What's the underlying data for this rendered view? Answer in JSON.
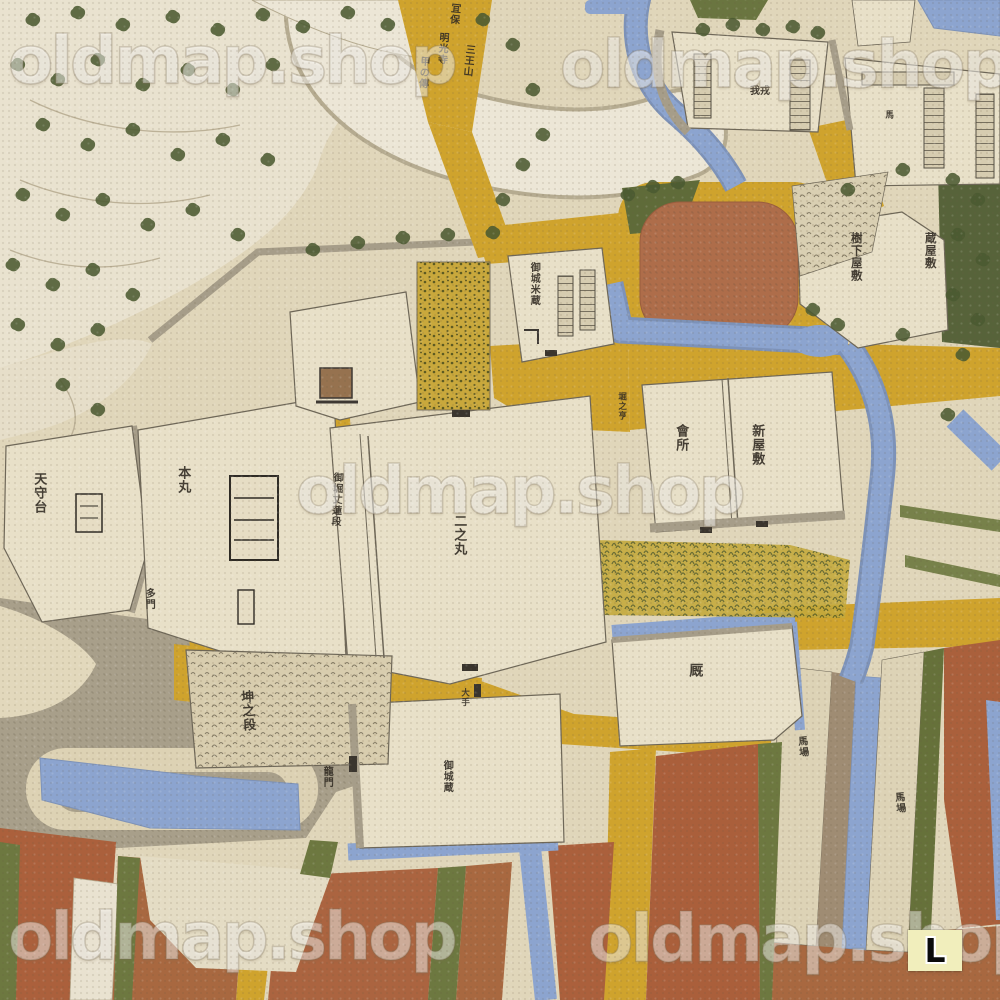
{
  "watermark": {
    "text": "oldmap.shop",
    "color": "#ffffff",
    "opacity": 0.46
  },
  "badge": {
    "label": "L",
    "background": "#f1eebc",
    "text_color": "#0b0b0b"
  },
  "map_labels": {
    "tenshudai": "天守台",
    "honmaru": "本丸",
    "tamon": "多門",
    "horibata": "御堀丈蓮段",
    "ninomaru": "二之丸",
    "okomekura": "御城米蔵",
    "horiguchi": "堀之亨",
    "kaisho": "會所",
    "shinyashiki": "新屋敷",
    "jugeyashiki": "樹下屋敷",
    "kurayashiki": "蔵屋敷",
    "umaya": "厩",
    "oshirokura": "御城蔵",
    "ryumon": "龍門",
    "hitsujisarudan": "坤之段",
    "ote": "大手",
    "baba1": "馬場",
    "baba2": "馬場",
    "compound_a": "我戎",
    "compound_b": "馬",
    "script1": "冝保",
    "script2": "三王山",
    "script3": "明光寺",
    "script4": "甲の傳"
  },
  "colors": {
    "parchment": "#e0d6ba",
    "mountain_cream": "#e9e2cf",
    "road_yellow": "#cfa32d",
    "water_blue": "#8ca4cf",
    "field_red": "#ad6a44",
    "vegetation_green": "#4c5a32",
    "hedge_olive": "#66713a",
    "wall_gray": "#a69d89",
    "ink": "#332d24"
  }
}
